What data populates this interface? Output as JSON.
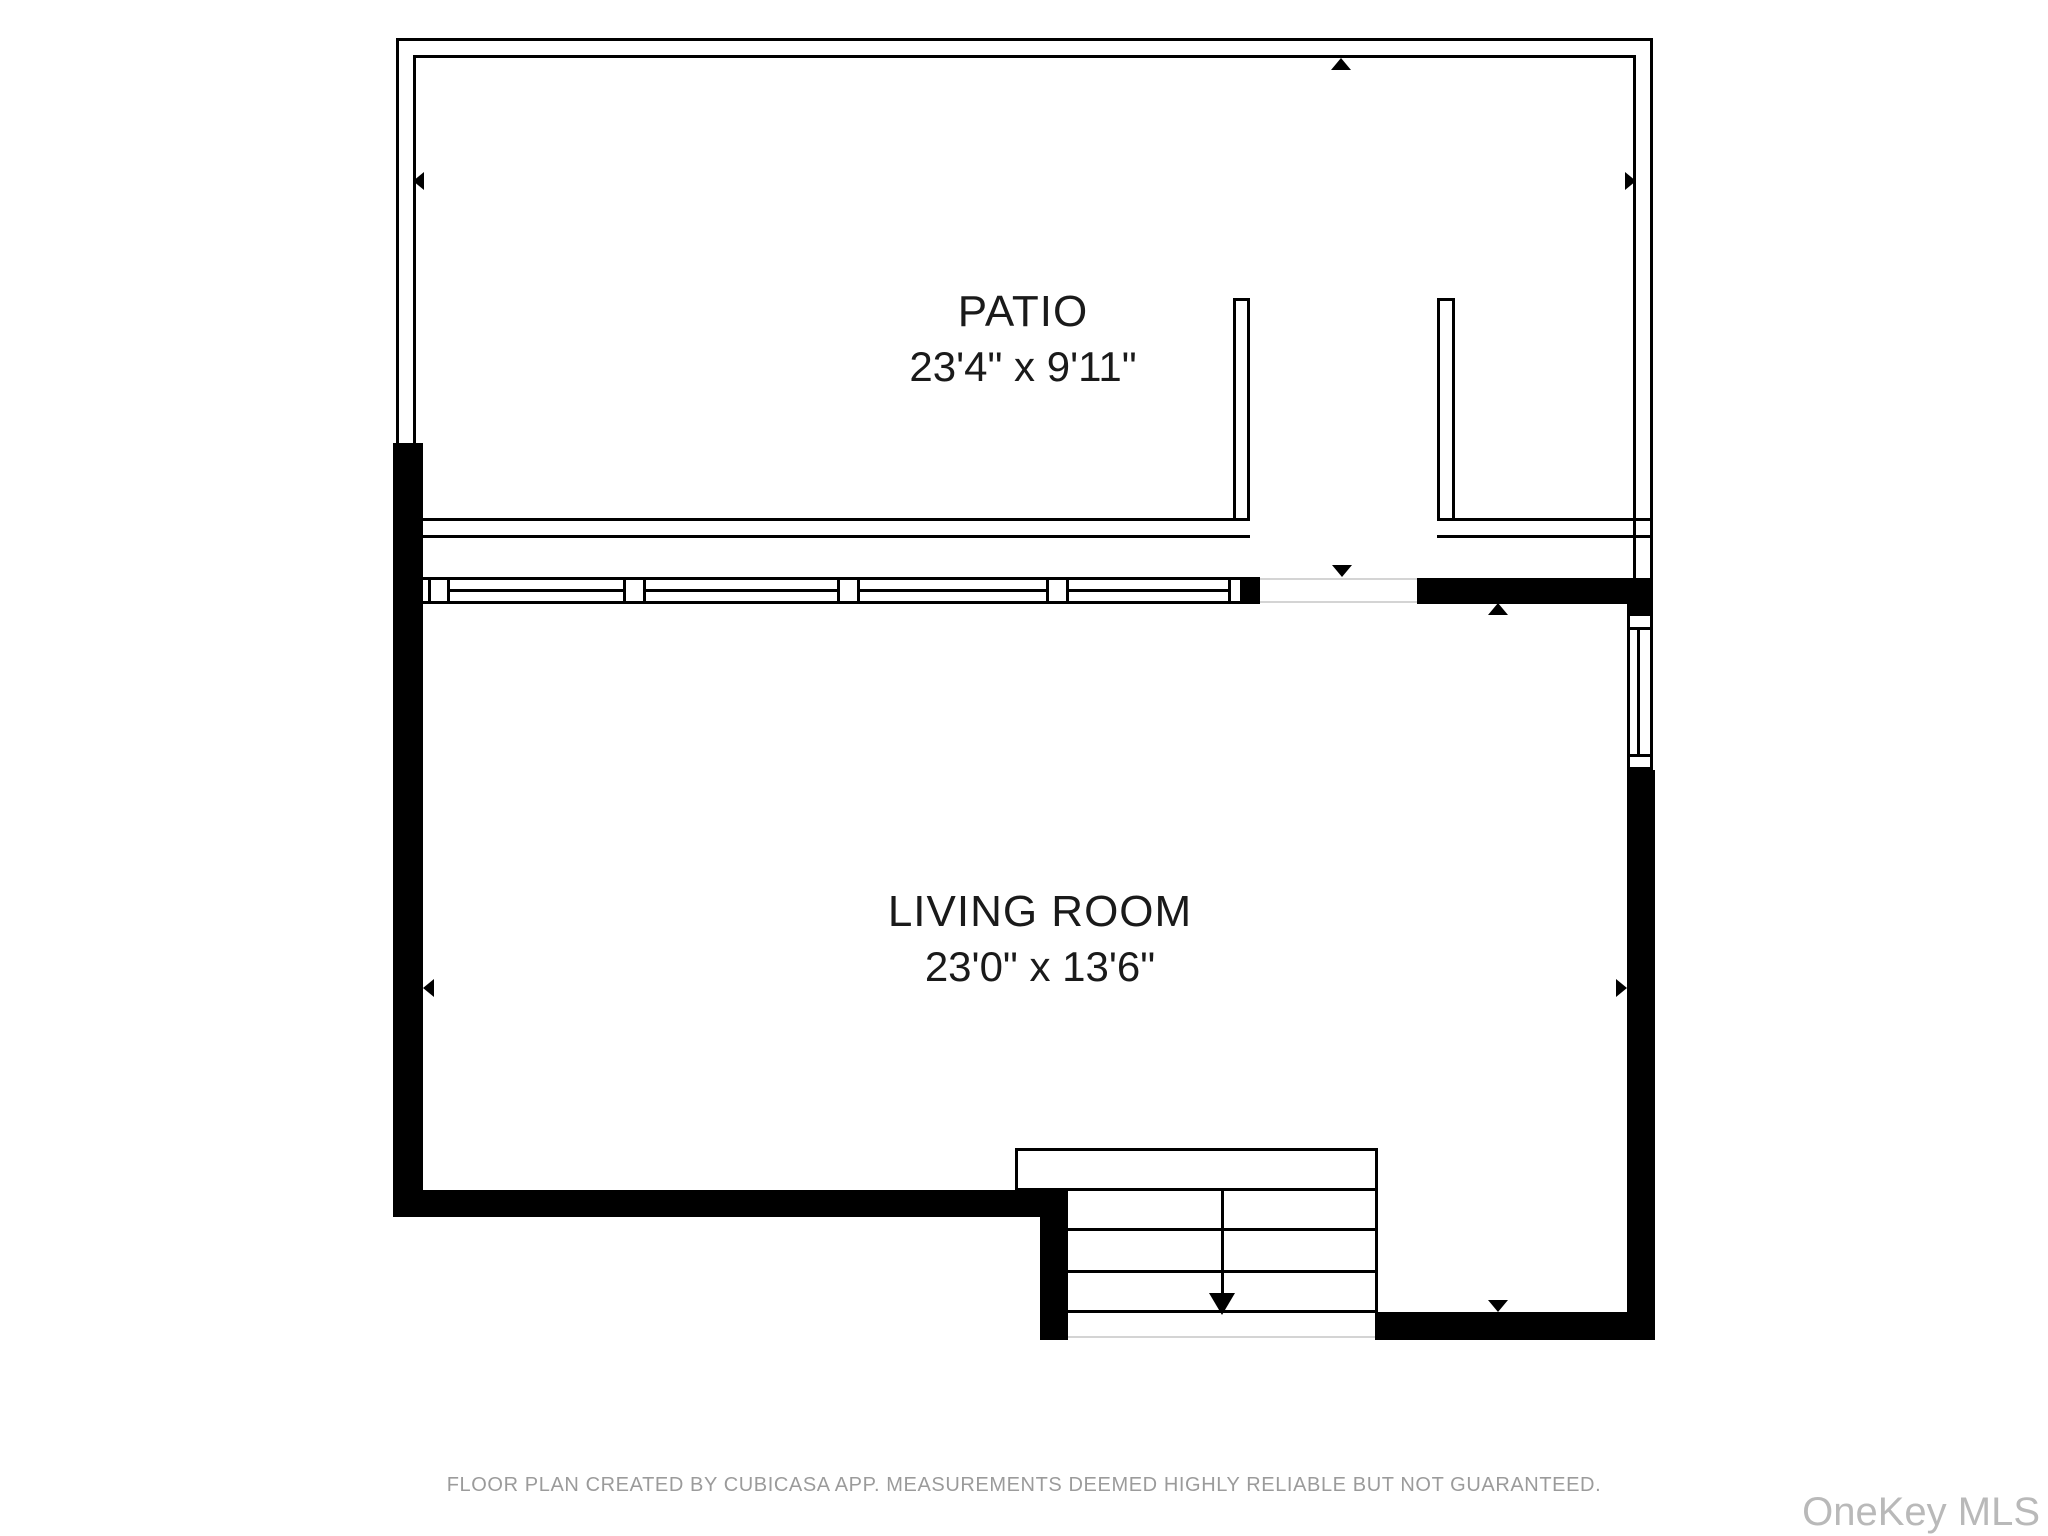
{
  "page": {
    "kind": "floor-plan",
    "background": "#ffffff"
  },
  "colors": {
    "wall_fill": "#000000",
    "wall_line": "#000000",
    "threshold_line": "#d4d4d4",
    "room_text": "#1a1a1a",
    "disclaimer_text": "#9b9b9b",
    "watermark_text": "#b9b9b9"
  },
  "rooms": [
    {
      "name": "PATIO",
      "dimensions": "23'4\" x 9'11\""
    },
    {
      "name": "LIVING ROOM",
      "dimensions": "23'0\" x 13'6\""
    }
  ],
  "markers": [
    "arrow-up-patio-top-wall",
    "arrow-left-patio-left-wall",
    "arrow-right-patio-right-wall",
    "arrow-down-patio-door-opening",
    "arrow-up-below-door-wall",
    "arrow-left-living-room-left-wall",
    "arrow-right-living-room-right-wall",
    "arrow-down-stairs-direction",
    "arrow-down-bottom-right-wall"
  ],
  "features": {
    "windows": "window band between patio and living room with four panes, vertical window on right wall",
    "stairs": "three steps with landing, arrow pointing down"
  },
  "footer": {
    "disclaimer": "FLOOR PLAN CREATED BY CUBICASA APP. MEASUREMENTS DEEMED HIGHLY RELIABLE BUT NOT GUARANTEED.",
    "watermark": "OneKey MLS"
  }
}
